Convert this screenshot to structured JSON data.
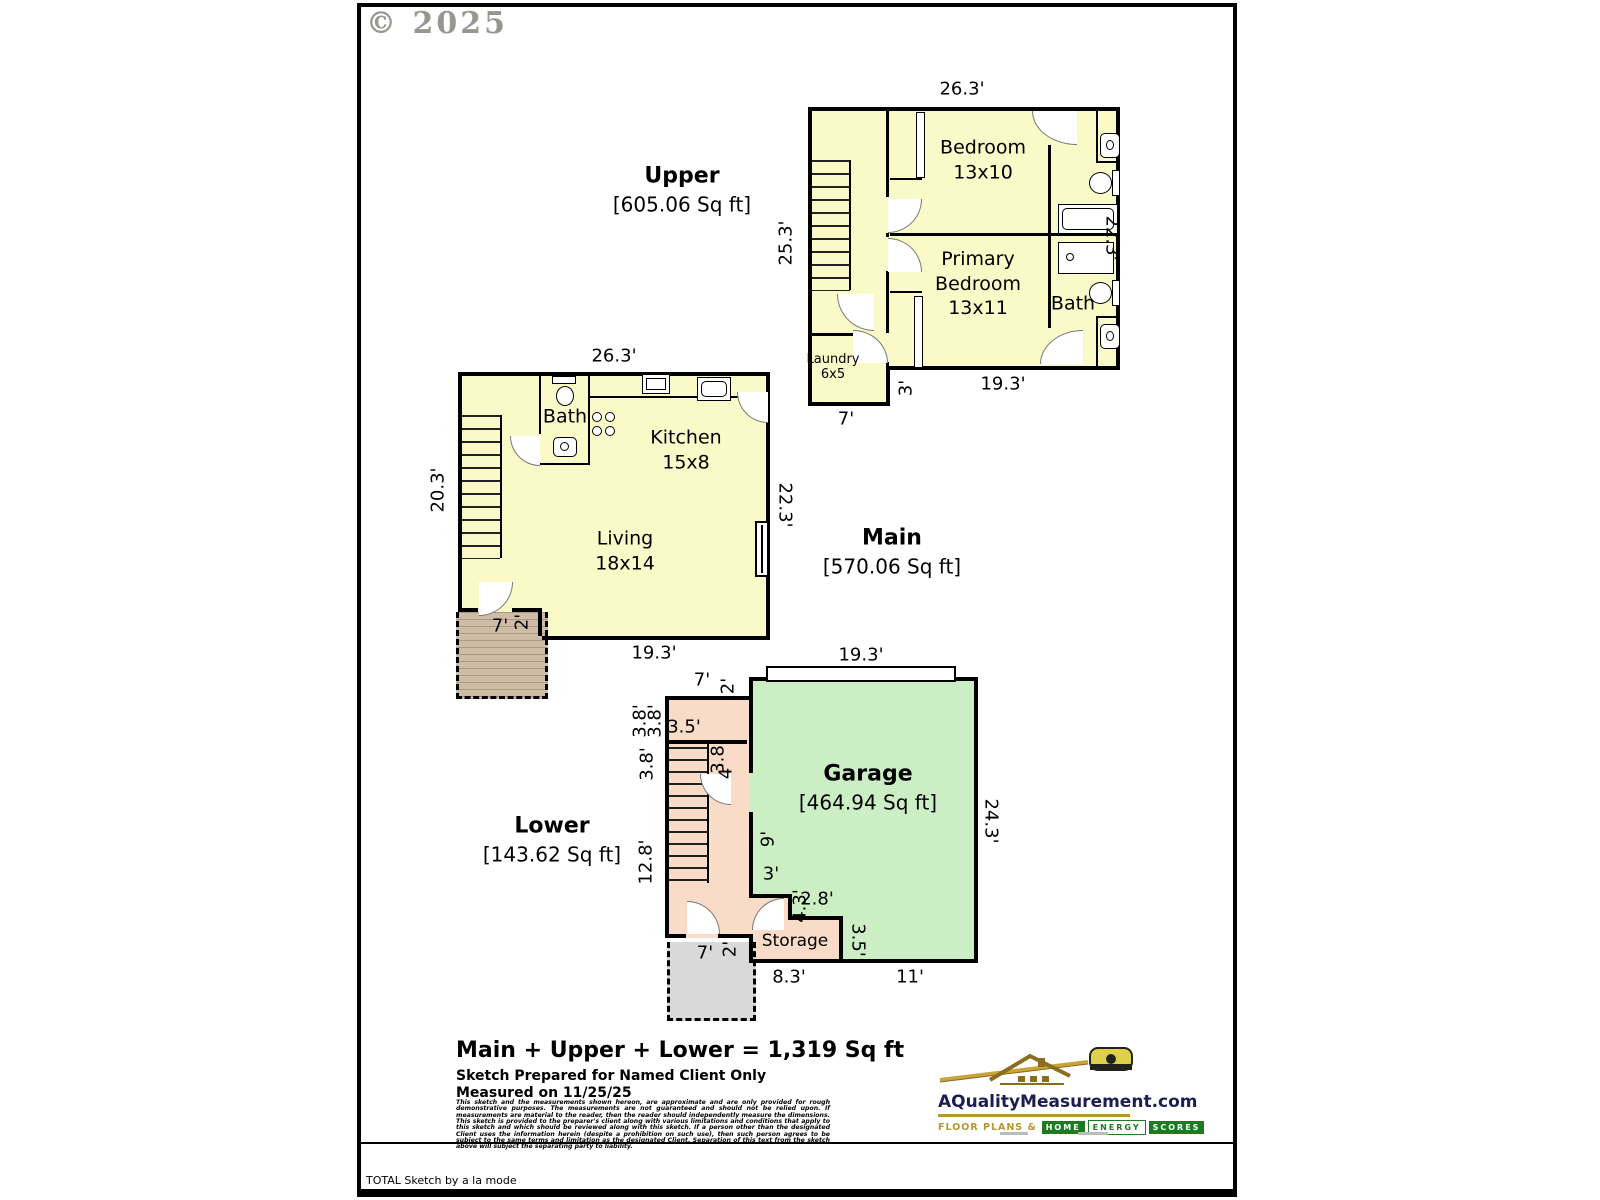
{
  "meta": {
    "copyright": "© 2025",
    "footer": "TOTAL Sketch by a la mode"
  },
  "upper": {
    "title": "Upper",
    "area": "[605.06 Sq ft]",
    "dim_top": "26.3'",
    "dim_left": "25.3'",
    "dim_right": "22.3'",
    "dim_bottom": "19.3'",
    "dim_step": "3'",
    "dim_laundry_w": "7'",
    "bedroom_l1": "Bedroom",
    "bedroom_l2": "13x10",
    "primary_l1": "Primary",
    "primary_l2": "Bedroom",
    "primary_l3": "13x11",
    "bath": "Bath",
    "laundry_l1": "Laundry",
    "laundry_l2": "6x5"
  },
  "main": {
    "title": "Main",
    "area": "[570.06 Sq ft]",
    "dim_top": "26.3'",
    "dim_left": "20.3'",
    "dim_right": "22.3'",
    "dim_bottom": "19.3'",
    "deck_w": "7'",
    "deck_d": "2'",
    "bath": "Bath",
    "kitchen_l1": "Kitchen",
    "kitchen_l2": "15x8",
    "living_l1": "Living",
    "living_l2": "18x14"
  },
  "lower": {
    "title": "Lower",
    "area": "[143.62 Sq ft]",
    "garage_l1": "Garage",
    "garage_l2": "[464.94 Sq ft]",
    "storage": "Storage",
    "dim_garage_w": "19.3'",
    "dim_right": "24.3'",
    "dim_top_w": "7'",
    "dim_top_d": "2'",
    "dim_38a": "3.8'",
    "dim_38b": "3.8'",
    "dim_38c": "3.8'",
    "dim_35": "3.5'",
    "dim_stair_38": "3.8'",
    "dim_stair_4": "4'",
    "dim_128": "12.8'",
    "dim_9": "9'",
    "dim_3": "3'",
    "dim_28": "2.8'",
    "dim_43": "4.3'",
    "dim_storage_h": "3.5'",
    "dim_83": "8.3'",
    "dim_11": "11'",
    "patio_w": "7'",
    "patio_d": "2'"
  },
  "summary": {
    "total": "Main + Upper + Lower = 1,319 Sq ft",
    "prepared_for": "Sketch Prepared for Named Client Only",
    "measured": "Measured on 11/25/25",
    "disclaimer": "This sketch and the measurements shown hereon, are approximate and are only provided for rough demonstrative purposes.  The measurements are not guaranteed and should not be relied upon.  If measurements are material to the reader, then the reader should independently measure the dimensions.  This sketch is provided to the preparer's client along with various limitations and conditions that apply to this sketch and which should be reviewed along with this sketch.  If a person other than the designated Client uses the information herein (despite a prohibition on such use), then such person agrees to be subject to the same terms and limitation as the designated Client.  Separation of this text from the sketch above will subject the separating party to liability."
  },
  "logo": {
    "domain": "AQualityMeasurement.com",
    "tagline_prefix": "FLOOR PLANS &",
    "word1": "HOME",
    "word2": "ENERGY",
    "word3": "SCORES"
  }
}
